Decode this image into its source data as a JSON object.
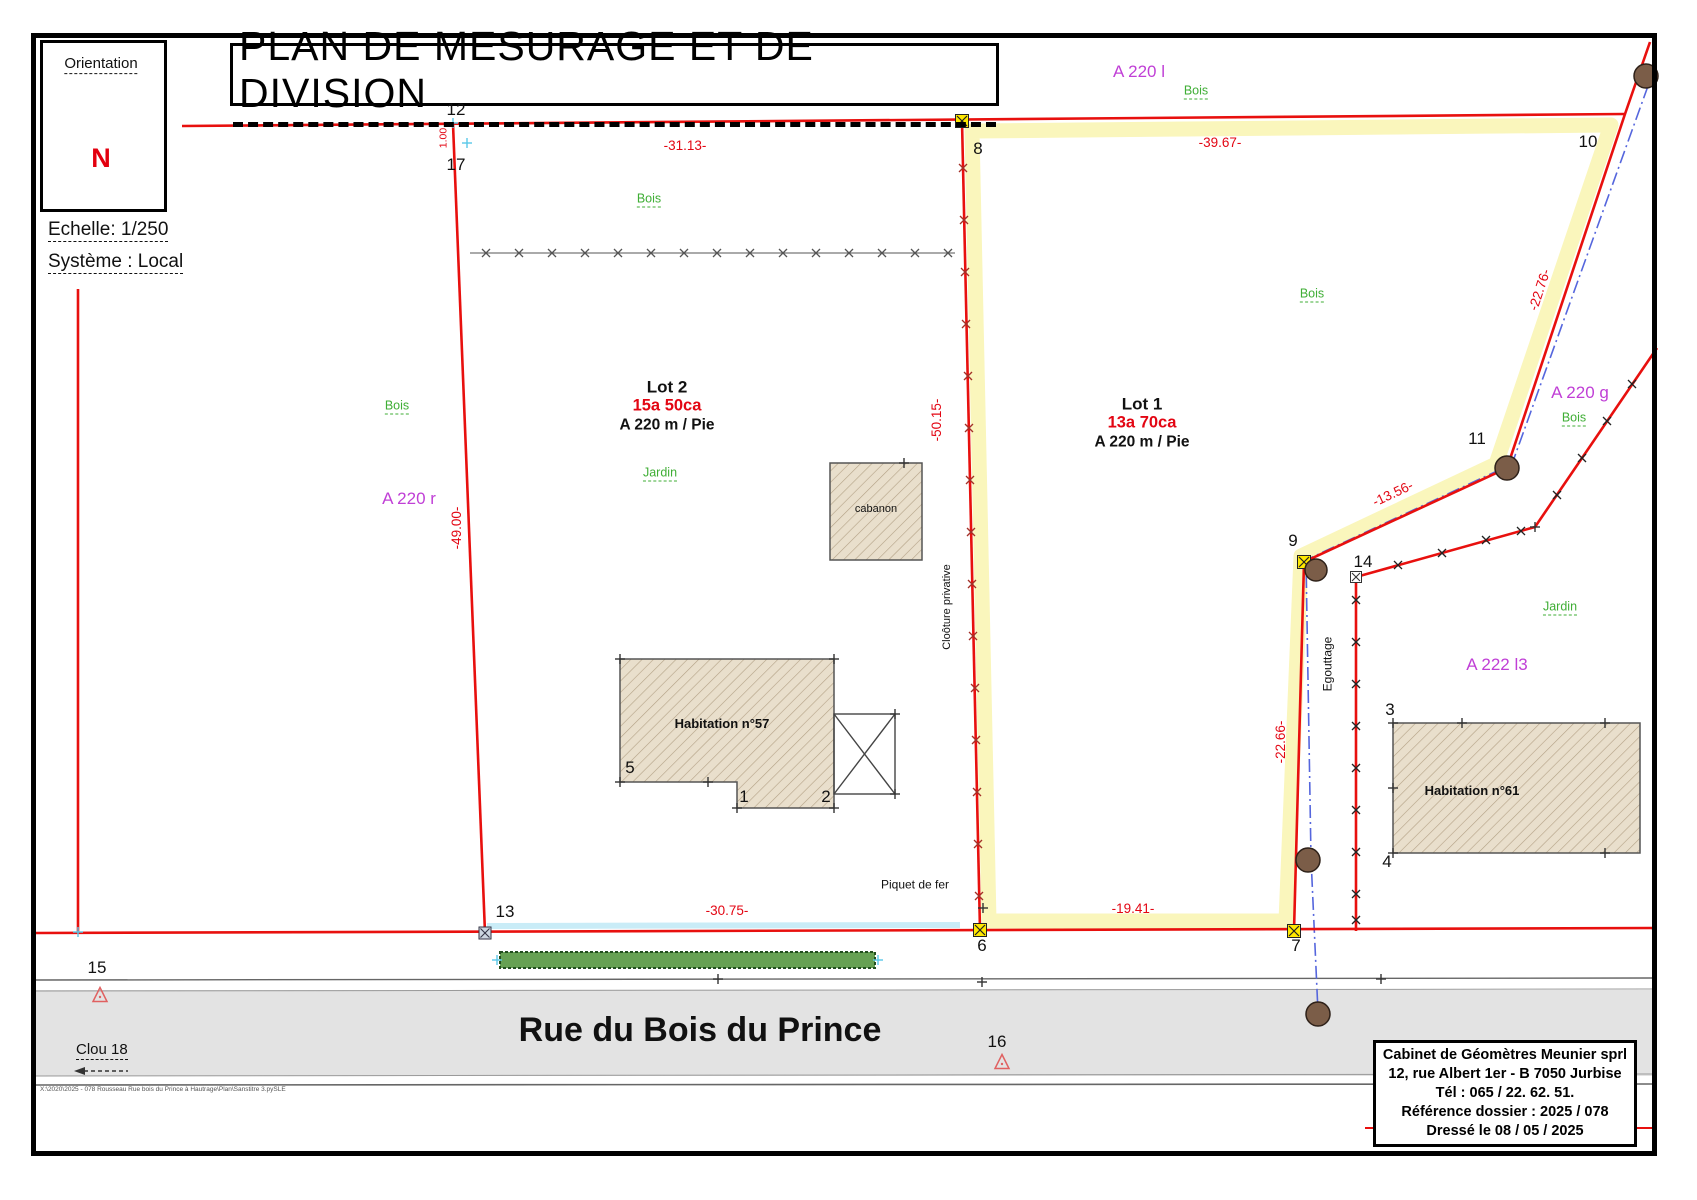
{
  "page": {
    "title": "PLAN DE MESURAGE ET DE DIVISION",
    "orientation_label": "Orientation",
    "north": "N",
    "scale": "Echelle: 1/250",
    "system": "Système : Local",
    "street": "Rue du Bois du Prince",
    "file_path": "X:\\2020\\2025 - 078 Rousseau Rue bois du Prince à Hautrage\\Plan\\Sanstitre 3.pySLE"
  },
  "lots": {
    "lot2": {
      "name": "Lot 2",
      "area": "15a 50ca",
      "cadastre": "A 220 m / Pie"
    },
    "lot1": {
      "name": "Lot 1",
      "area": "13a 70ca",
      "cadastre": "A 220 m / Pie"
    }
  },
  "parcel_labels": {
    "a220l": "A 220 l",
    "a220r": "A 220 r",
    "a220g": "A 220 g",
    "a222l3": "A 222 l3"
  },
  "land_labels": {
    "bois": "Bois",
    "jardin": "Jardin"
  },
  "measurements": {
    "m1": "-31.13-",
    "m2": "-39.67-",
    "m3": "-22.76-",
    "m4": "-13.56-",
    "m5": "-22.66-",
    "m6": "-50.15-",
    "m7": "-49.00-",
    "m8": "-30.75-",
    "m9": "-19.41-",
    "m10": "1.00"
  },
  "points": {
    "p1": "1",
    "p2": "2",
    "p3": "3",
    "p4": "4",
    "p5": "5",
    "p6": "6",
    "p7": "7",
    "p8": "8",
    "p9": "9",
    "p10": "10",
    "p11": "11",
    "p12": "12",
    "p13": "13",
    "p14": "14",
    "p15": "15",
    "p16": "16",
    "p17": "17",
    "clou18": "Clou 18"
  },
  "buildings": {
    "h57": "Habitation n°57",
    "h61": "Habitation n°61",
    "cabanon": "cabanon"
  },
  "annotations": {
    "cloture": "Cloôture privative",
    "egouttage": "Egouttage",
    "piquet": "Piquet de fer"
  },
  "cartouche": {
    "l1": "Cabinet de Géomètres Meunier sprl",
    "l2": "12, rue Albert 1er - B 7050 Jurbise",
    "l3": "Tél : 065 / 22. 62. 51.",
    "l4": "Référence dossier : 2025 / 078",
    "l5": "Dressé le 08 / 05 / 2025"
  },
  "colors": {
    "boundary_red": "#e8100e",
    "measure_red": "#e30613",
    "parcel_purple": "#c03fd6",
    "vegetation_green": "#3fae35",
    "lot_highlight": "#faf6bc",
    "egouttage_blue": "#5566dd",
    "road_gray": "#e3e3e3"
  }
}
